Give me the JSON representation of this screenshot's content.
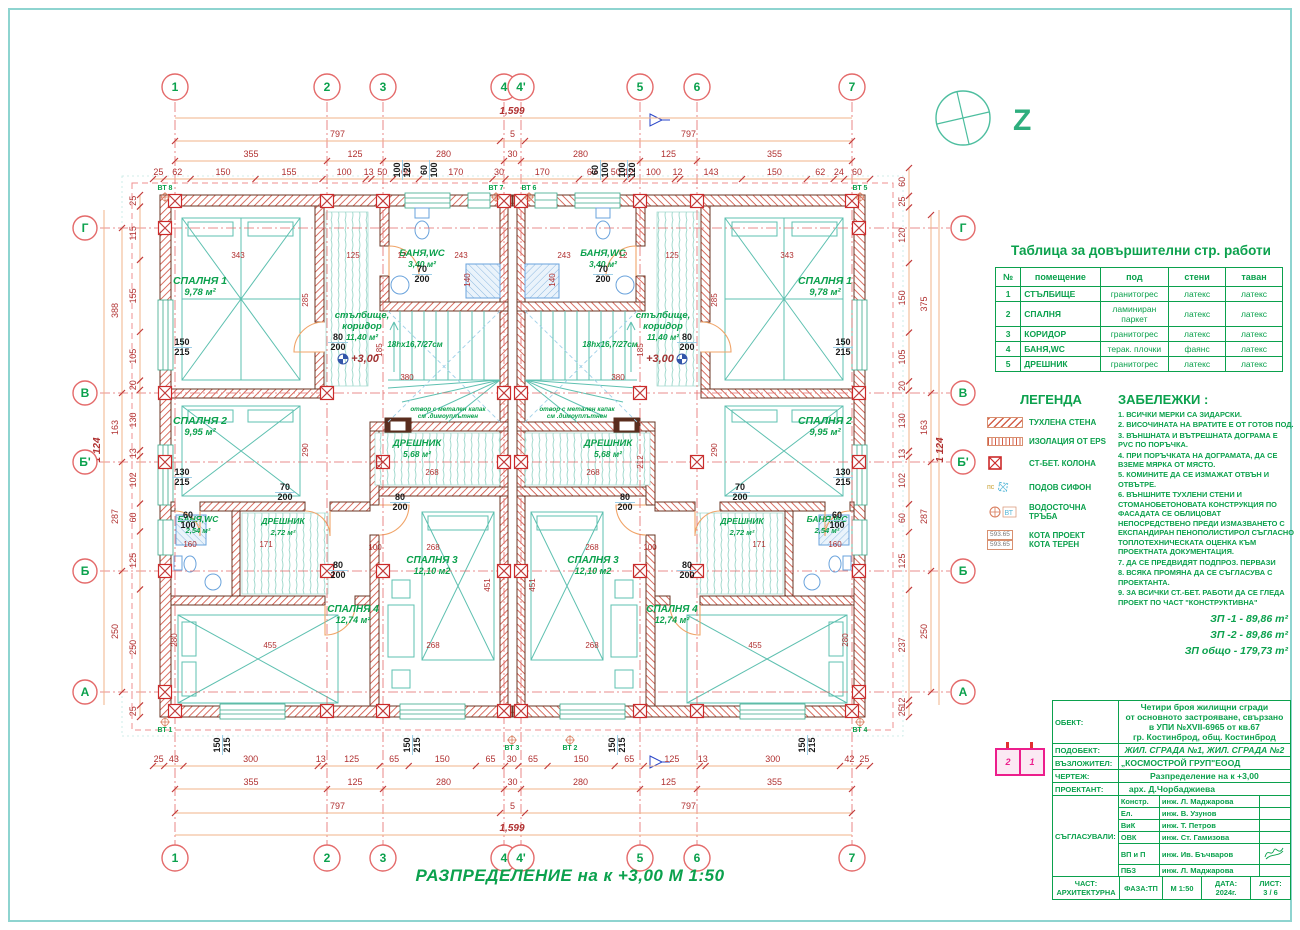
{
  "plan": {
    "grid_top_labels": [
      "1",
      "2",
      "3",
      "4",
      "4'",
      "5",
      "6",
      "7"
    ],
    "grid_side_labels": [
      "Г",
      "В",
      "Б'",
      "Б",
      "А"
    ],
    "dims": {
      "top_total": "1,599",
      "top_halves": [
        "797",
        "5",
        "797"
      ],
      "top_axes": [
        "355",
        "125",
        "280",
        "30",
        "280",
        "125",
        "355"
      ],
      "top_detail": [
        "25",
        "62",
        "150",
        "155",
        "100",
        "13",
        "50",
        "60",
        "170",
        "30",
        "170",
        "60",
        "50",
        "12",
        "100",
        "12",
        "143",
        "150",
        "62",
        "24",
        "60"
      ],
      "bottom_detail": [
        "25",
        "43",
        "300",
        "13",
        "125",
        "65",
        "150",
        "65",
        "30",
        "65",
        "150",
        "65",
        "125",
        "13",
        "300",
        "42",
        "25"
      ],
      "bottom_axes": [
        "355",
        "125",
        "280",
        "30",
        "280",
        "125",
        "355"
      ],
      "bottom_halves": [
        "797",
        "5",
        "797"
      ],
      "bottom_total": "1,599",
      "left_detail": [
        "25",
        "115",
        "155",
        "105",
        "20",
        "130",
        "13",
        "102",
        "60",
        "125",
        "250",
        "25"
      ],
      "left_axes": [
        "388",
        "163",
        "287",
        "250"
      ],
      "left_total": "1 124",
      "right_detail": [
        "60",
        "25",
        "120",
        "150",
        "105",
        "20",
        "130",
        "13",
        "102",
        "60",
        "125",
        "237",
        "12",
        "25"
      ],
      "right_axes": [
        "375",
        "163",
        "287",
        "250"
      ],
      "right_total": "1 124"
    },
    "rooms": [
      {
        "name": "СПАЛНЯ 1",
        "area": "9,78 м²"
      },
      {
        "name": "СПАЛНЯ 2",
        "area": "9,95 м²"
      },
      {
        "name": "БАНЯ,WC",
        "area": "3,40 м²"
      },
      {
        "name": "стълбище,",
        "name2": "коридор",
        "area": "11,40 м²"
      },
      {
        "name": "ДРЕШНИК",
        "area": "5,68 м²"
      },
      {
        "name": "БАНЯ,WC",
        "area": "2,54 м²"
      },
      {
        "name": "ДРЕШНИК",
        "area": "2,72 м²"
      },
      {
        "name": "СПАЛНЯ 4",
        "area": "12,74 м²"
      },
      {
        "name": "СПАЛНЯ 3",
        "area": "12,10 м2"
      }
    ],
    "stair_note": "18hx16,7/27см",
    "level_mark": "+3,00",
    "opening_note_1": "отвор с метален капак",
    "opening_note_2": "см .димоуплътнен",
    "size_labels": [
      "150|215",
      "130|215",
      "60|100",
      "70|200",
      "80|200",
      "80|200",
      "70|200",
      "80|200",
      "100|120",
      "60|100",
      "150|215",
      "150|215"
    ],
    "inner_dims": [
      "343",
      "125",
      "243",
      "380",
      "268",
      "268",
      "455",
      "268",
      "171",
      "160",
      "285",
      "290",
      "280",
      "185",
      "212",
      "451",
      "140",
      "100",
      "12"
    ],
    "vt_labels": [
      "ВТ 8",
      "ВТ 7",
      "ВТ 6",
      "ВТ 5",
      "ВТ 1",
      "ВТ 2",
      "ВТ 3",
      "ВТ 4"
    ],
    "north_label": "Z"
  },
  "finish_table": {
    "title": "Таблица за довършителни стр. работи",
    "headers": [
      "№",
      "помещение",
      "под",
      "стени",
      "таван"
    ],
    "rows": [
      [
        "1",
        "СТЪЛБИЩЕ",
        "гранитогрес",
        "латекс",
        "латекс"
      ],
      [
        "2",
        "СПАЛНЯ",
        "ламиниран паркет",
        "латекс",
        "латекс"
      ],
      [
        "3",
        "КОРИДОР",
        "гранитогрес",
        "латекс",
        "латекс"
      ],
      [
        "4",
        "БАНЯ,WC",
        "терак. плочки",
        "фаянс",
        "латекс"
      ],
      [
        "5",
        "ДРЕШНИК",
        "гранитогрес",
        "латекс",
        "латекс"
      ]
    ]
  },
  "legend": {
    "title": "ЛЕГЕНДА",
    "items": [
      {
        "label": "ТУХЛЕНА СТЕНА"
      },
      {
        "label": "ИЗОЛАЦИЯ ОТ EPS"
      },
      {
        "label": "СТ-БЕТ.  КОЛОНА"
      },
      {
        "label": "ПОДОВ СИФОН",
        "prefix": "пс"
      },
      {
        "label": "ВОДОСТОЧНА  ТРЪБА",
        "prefix": "ВТ"
      },
      {
        "label": "КОТА ПРОЕКТ",
        "label2": "КОТА ТЕРЕН",
        "val1": "593.65",
        "val2": "593.65"
      }
    ]
  },
  "notes": {
    "title": "ЗАБЕЛЕЖКИ :",
    "items": [
      "1. ВСИЧКИ МЕРКИ СА ЗИДАРСКИ.",
      "2. ВИСОЧИНАТА НА ВРАТИТЕ Е ОТ ГОТОВ ПОД.",
      "3. ВЪНШНАТА И ВЪТРЕШНАТА ДОГРАМА Е PVC ПО ПОРЪЧКА.",
      "4. ПРИ ПОРЪЧКАТА НА ДОГРАМАТА, ДА СЕ ВЗЕМЕ МЯРКА ОТ МЯСТО.",
      "5. КОМИНИТЕ ДА СЕ ИЗМАЖАТ ОТВЪН И ОТВЪТРЕ.",
      "6. ВЪНШНИТЕ ТУХЛЕНИ СТЕНИ И СТОМАНОБЕТОНОВАТА  КОНСТРУКЦИЯ ПО ФАСАДАТА СЕ ОБЛИЦОВАТ НЕПОСРЕДСТВЕНО ПРЕДИ ИЗМАЗВАНЕТО С ЕКСПАНДИРАН ПЕНОПОЛИСТИРОЛ СЪГЛАСНО ТОПЛОТЕХНИЧЕСКАТА ОЦЕНКА КЪМ ПРОЕКТНАТА ДОКУМЕНТАЦИЯ.",
      "7. ДА СЕ ПРЕДВИДЯТ ПОДПРОЗ. ПЕРВАЗИ",
      "8. ВСЯКА ПРОМЯНА ДА СЕ СЪГЛАСУВА С ПРОЕКТАНТА.",
      "9. ЗА ВСИЧКИ СТ.-БЕТ. РАБОТИ ДА СЕ ГЛЕДА ПРОЕКТ ПО ЧАСТ \"КОНСТРУКТИВНА\""
    ]
  },
  "areas": {
    "zp1": "ЗП -1 -  89,86 m²",
    "zp2": "ЗП -2 -  89,86 m²",
    "total": "ЗП общо  -  179,73 m²"
  },
  "titleblock": {
    "object_label": "ОБЕКТ:",
    "object_value_lines": [
      "Четири броя жилищни сгради",
      "от основното застрояване, свързано",
      "в УПИ №XVII-6965 от кв.67",
      "гр. Костинброд, общ. Костинброд"
    ],
    "subobject_label": "ПОДОБЕКТ:",
    "subobject_value": "ЖИЛ. СГРАДА №1, ЖИЛ. СГРАДА №2",
    "client_label": "ВЪЗЛОЖИТЕЛ:",
    "client_value": "„КОСМОСТРОЙ ГРУП\"ЕООД",
    "drawing_label": "ЧЕРТЕЖ:",
    "drawing_value": "Разпределение на к +3,00",
    "designer_label": "ПРОЕКТАНТ:",
    "designer_value": "арх. Д.Чорбаджиева",
    "approvals_label": "СЪГЛАСУВАЛИ:",
    "approvals": [
      [
        "Констр.",
        "инж. Л. Маджарова"
      ],
      [
        "Ел.",
        "инж. В. Узунов"
      ],
      [
        "ВиК",
        "инж. Т. Петров"
      ],
      [
        "ОВК",
        "инж. Ст. Гамизова"
      ],
      [
        "ВП и П",
        "инж. Ив. Бъчваров"
      ],
      [
        "ПБЗ",
        "инж. Л. Маджарова"
      ]
    ],
    "part_label": "ЧАСТ:",
    "part_value": "АРХИТЕКТУРНА",
    "phase": "ФАЗА:ТП",
    "scale": "М 1:50",
    "date_label": "ДАТА:",
    "date_value": "2024г.",
    "sheet_label": "ЛИСТ:",
    "sheet_value": "3 / 6"
  },
  "keyplan": {
    "left": "2",
    "right": "1"
  },
  "footer_title": "РАЗПРЕДЕЛЕНИЕ на к +3,00   М 1:50"
}
